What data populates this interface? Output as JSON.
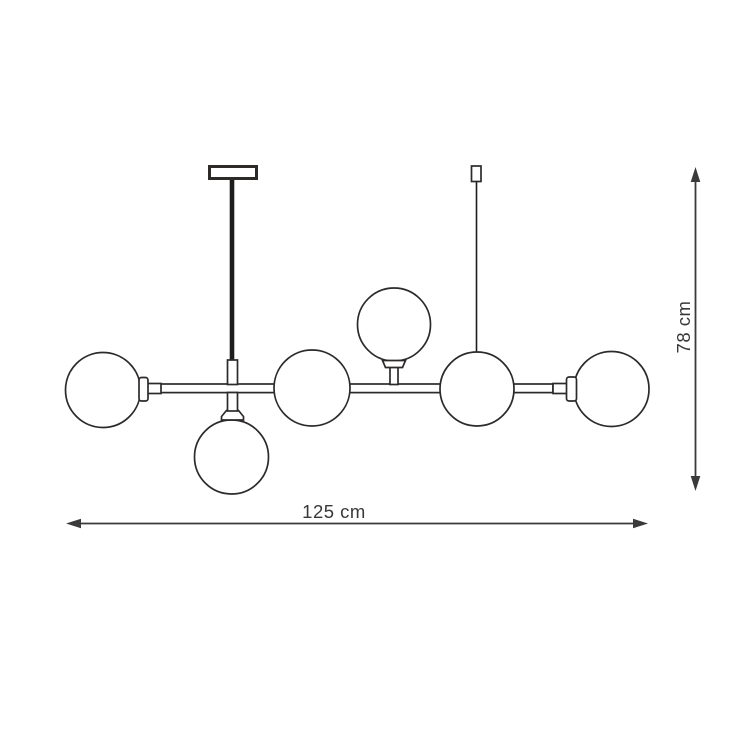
{
  "diagram": {
    "subject": "linear-chandelier-technical-dimension-drawing",
    "globe_count": 6,
    "colors": {
      "background": "#ffffff",
      "outline": "#2d2b2a",
      "solid": "#1e1d1d",
      "dimension": "#3a3a3a",
      "label_text": "#383838"
    },
    "dimensions": {
      "width": {
        "label": "125 cm"
      },
      "height": {
        "label": "78 cm"
      }
    }
  }
}
